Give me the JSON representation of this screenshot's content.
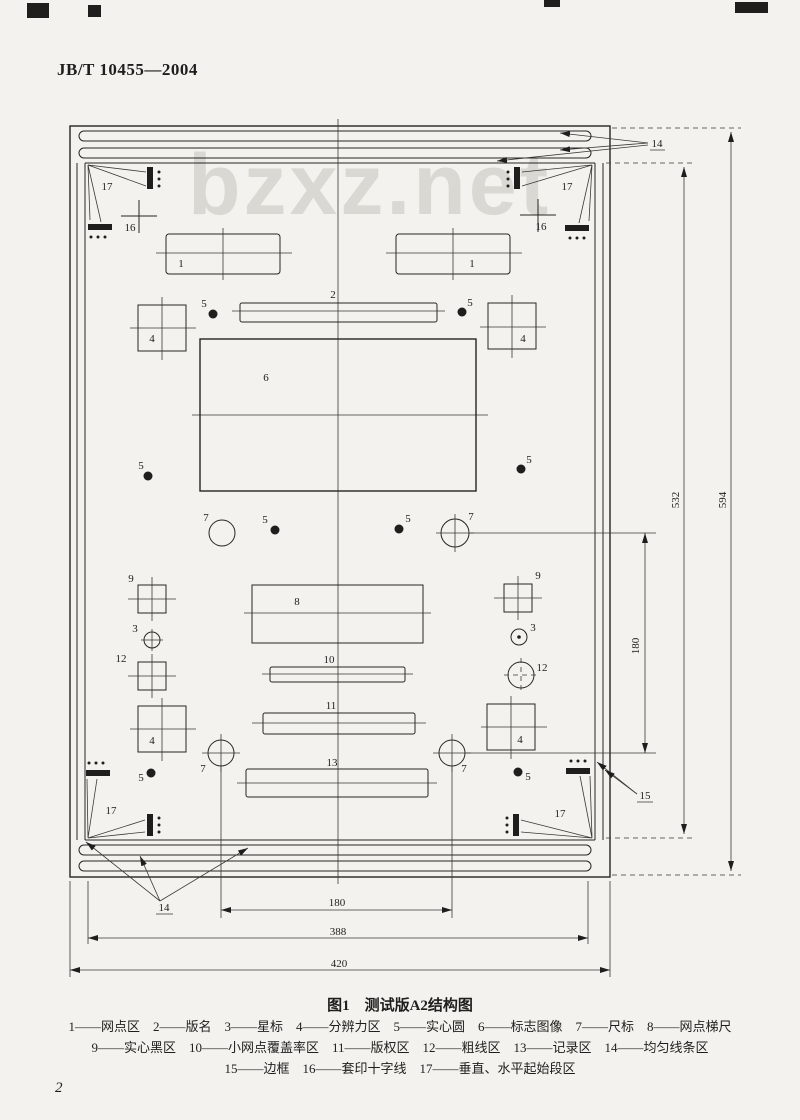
{
  "page": {
    "header": "JB/T 10455—2004",
    "watermark": "bzxz.net",
    "page_number": "2"
  },
  "figure": {
    "caption": "图1　测试版A2结构图",
    "legend_rows": [
      "1——网点区　2——版名　3——星标　4——分辨力区　5——实心圆　6——标志图像　7——尺标　8——网点梯尺",
      "9——实心黑区　10——小网点覆盖率区　11——版权区　12——粗线区　13——记录区　14——均匀线条区",
      "15——边框　16——套印十字线　17——垂直、水平起始段区"
    ],
    "labels": {
      "n1": "1",
      "n2": "2",
      "n3": "3",
      "n4": "4",
      "n5": "5",
      "n6": "6",
      "n7": "7",
      "n8": "8",
      "n9": "9",
      "n10": "10",
      "n11": "11",
      "n12": "12",
      "n13": "13",
      "n14": "14",
      "n15": "15",
      "n16": "16",
      "n17": "17",
      "d180": "180",
      "d388": "388",
      "d420": "420",
      "d532": "532",
      "d594": "594"
    }
  }
}
